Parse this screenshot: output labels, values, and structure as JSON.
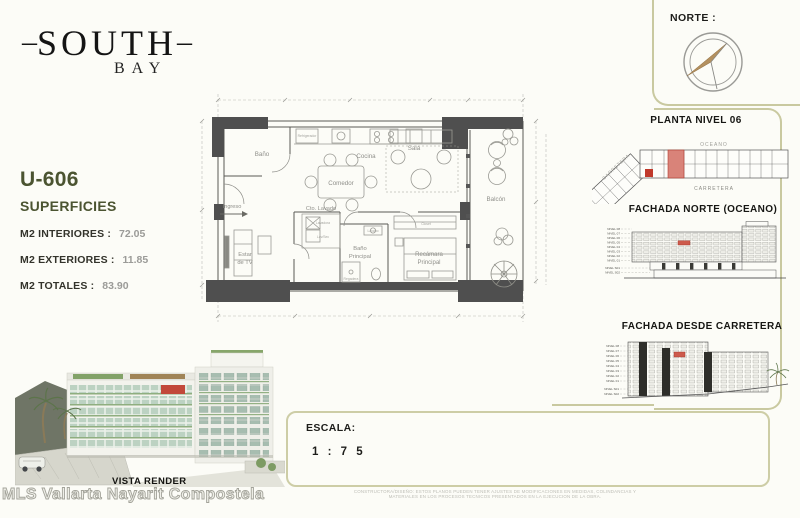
{
  "colors": {
    "brand_olive": "#4b5431",
    "panel_border_olive": "#c9c9a0",
    "highlight_red": "#cd5a4c",
    "structure_charcoal": "#4f4f4f",
    "compass_tan": "#b3905f"
  },
  "brand": {
    "dash_left": "–",
    "name": "SOUTH",
    "dash_right": "–",
    "sub": "BAY"
  },
  "unit_info": {
    "unit_id": "U-606",
    "section_title": "SUPERFICIES",
    "metrics": [
      {
        "label": "M2 INTERIORES :",
        "value": "72.05"
      },
      {
        "label": "M2 EXTERIORES :",
        "value": "11.85"
      },
      {
        "label": "M2 TOTALES :",
        "value": "83.90"
      }
    ]
  },
  "north": {
    "label": "NORTE :"
  },
  "floorplan": {
    "rooms": {
      "bano": "Baño",
      "cocina": "Cocina",
      "comedor": "Comedor",
      "sala": "Sala",
      "balcon": "Balcón",
      "ingreso": "Ingreso",
      "estar_1": "Estar",
      "estar_2": "de TV",
      "cto_lavado": "Cto. Lavado",
      "banop_1": "Baño",
      "banop_2": "Principal",
      "rec_1": "Recámara",
      "rec_2": "Principal"
    },
    "fixtures": {
      "refrigerador": "Refrigerador",
      "lavadora": "Lavadora",
      "lav_sec": "Lav/Sec",
      "closet": "Closet",
      "regadera": "Regadera",
      "lavabo": "Lavabo"
    }
  },
  "sidebar": {
    "planta": {
      "title": "PLANTA NIVEL 06",
      "label_oceano": "OCEANO",
      "label_carretera": "CARRETERA",
      "label_carretera_side": "CARRETERA"
    },
    "fachada_norte": {
      "title": "FACHADA NORTE (OCEANO)",
      "levels": [
        "NIVEL 08",
        "NIVEL 07",
        "NIVEL 06",
        "NIVEL 05",
        "NIVEL 04",
        "NIVEL 03",
        "NIVEL 02",
        "NIVEL 01",
        "NIVEL S01",
        "NIVEL S02"
      ]
    },
    "fachada_carretera": {
      "title": "FACHADA DESDE CARRETERA",
      "levels": [
        "NIVEL 08",
        "NIVEL 07",
        "NIVEL 06",
        "NIVEL 05",
        "NIVEL 04",
        "NIVEL 03",
        "NIVEL 02",
        "NIVEL 01",
        "NIVEL S01",
        "NIVEL S02"
      ]
    }
  },
  "render": {
    "caption": "VISTA RENDER"
  },
  "watermark": {
    "text": "MLS Vallarta Nayarit Compostela"
  },
  "escala": {
    "label": "ESCALA:",
    "value": "1 : 7 5"
  },
  "disclaimer": {
    "line1": "CONSTRUCTORA/DISEÑO: ESTOS PLANOS PUEDEN TENER AJUSTES DE MODIFICACIONES EN MEDIDAS, COLINDANCIAS Y",
    "line2": "MATERIALES EN LOS PROCESOS TECNICOS PRESENTADOS EN LA EJECUCION DE LA OBRA."
  }
}
